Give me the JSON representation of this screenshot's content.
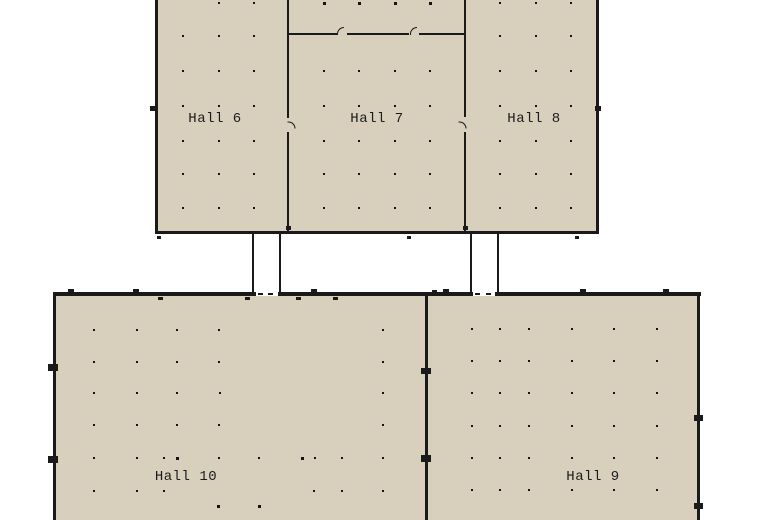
{
  "map": {
    "type": "venue-floor-plan",
    "halls": [
      {
        "id": "hall-6",
        "label": "Hall 6"
      },
      {
        "id": "hall-7",
        "label": "Hall 7"
      },
      {
        "id": "hall-8",
        "label": "Hall 8"
      },
      {
        "id": "hall-9",
        "label": "Hall 9"
      },
      {
        "id": "hall-10",
        "label": "Hall 10"
      }
    ]
  },
  "colors": {
    "background": "#ffffff",
    "hall_fill": "#d8cfbd",
    "wall": "#1a1a1a",
    "corridor": "#ffffff",
    "dot": "#141414",
    "label": "#1c1c1c"
  },
  "dots": {
    "points": [
      [
        218,
        2
      ],
      [
        253,
        2
      ],
      [
        182,
        35
      ],
      [
        218,
        35
      ],
      [
        253,
        35
      ],
      [
        182,
        70
      ],
      [
        218,
        70
      ],
      [
        253,
        70
      ],
      [
        182,
        105
      ],
      [
        218,
        105
      ],
      [
        253,
        105
      ],
      [
        182,
        140
      ],
      [
        218,
        140
      ],
      [
        253,
        140
      ],
      [
        182,
        173
      ],
      [
        218,
        173
      ],
      [
        253,
        173
      ],
      [
        182,
        207
      ],
      [
        218,
        207
      ],
      [
        253,
        207
      ],
      [
        323,
        70
      ],
      [
        358,
        70
      ],
      [
        394,
        70
      ],
      [
        429,
        70
      ],
      [
        323,
        105
      ],
      [
        358,
        105
      ],
      [
        394,
        105
      ],
      [
        429,
        105
      ],
      [
        323,
        140
      ],
      [
        358,
        140
      ],
      [
        394,
        140
      ],
      [
        429,
        140
      ],
      [
        323,
        173
      ],
      [
        358,
        173
      ],
      [
        394,
        173
      ],
      [
        429,
        173
      ],
      [
        323,
        207
      ],
      [
        358,
        207
      ],
      [
        394,
        207
      ],
      [
        429,
        207
      ],
      [
        499,
        2
      ],
      [
        535,
        2
      ],
      [
        570,
        2
      ],
      [
        499,
        35
      ],
      [
        535,
        35
      ],
      [
        570,
        35
      ],
      [
        499,
        70
      ],
      [
        535,
        70
      ],
      [
        570,
        70
      ],
      [
        499,
        105
      ],
      [
        535,
        105
      ],
      [
        570,
        105
      ],
      [
        499,
        140
      ],
      [
        535,
        140
      ],
      [
        570,
        140
      ],
      [
        499,
        173
      ],
      [
        535,
        173
      ],
      [
        570,
        173
      ],
      [
        499,
        207
      ],
      [
        535,
        207
      ],
      [
        570,
        207
      ],
      [
        471,
        328
      ],
      [
        499,
        328
      ],
      [
        528,
        328
      ],
      [
        571,
        328
      ],
      [
        613,
        328
      ],
      [
        656,
        328
      ],
      [
        471,
        360
      ],
      [
        499,
        360
      ],
      [
        528,
        360
      ],
      [
        571,
        360
      ],
      [
        613,
        360
      ],
      [
        656,
        360
      ],
      [
        471,
        392
      ],
      [
        499,
        392
      ],
      [
        528,
        392
      ],
      [
        571,
        392
      ],
      [
        613,
        392
      ],
      [
        656,
        392
      ],
      [
        471,
        425
      ],
      [
        499,
        425
      ],
      [
        528,
        425
      ],
      [
        571,
        425
      ],
      [
        613,
        425
      ],
      [
        656,
        425
      ],
      [
        471,
        457
      ],
      [
        499,
        457
      ],
      [
        528,
        457
      ],
      [
        571,
        457
      ],
      [
        613,
        457
      ],
      [
        656,
        457
      ],
      [
        471,
        489
      ],
      [
        499,
        489
      ],
      [
        528,
        489
      ],
      [
        571,
        489
      ],
      [
        613,
        489
      ],
      [
        656,
        489
      ],
      [
        93,
        329
      ],
      [
        136,
        329
      ],
      [
        176,
        329
      ],
      [
        218,
        329
      ],
      [
        382,
        329
      ],
      [
        93,
        361
      ],
      [
        136,
        361
      ],
      [
        176,
        361
      ],
      [
        218,
        361
      ],
      [
        382,
        361
      ],
      [
        93,
        392
      ],
      [
        136,
        392
      ],
      [
        176,
        392
      ],
      [
        219,
        392
      ],
      [
        382,
        392
      ],
      [
        93,
        424
      ],
      [
        136,
        424
      ],
      [
        176,
        424
      ],
      [
        218,
        424
      ],
      [
        382,
        424
      ],
      [
        93,
        457
      ],
      [
        136,
        457
      ],
      [
        163,
        457
      ],
      [
        218,
        457
      ],
      [
        258,
        457
      ],
      [
        314,
        457
      ],
      [
        341,
        457
      ],
      [
        382,
        457
      ],
      [
        93,
        490
      ],
      [
        136,
        490
      ],
      [
        163,
        490
      ],
      [
        313,
        490
      ],
      [
        341,
        490
      ],
      [
        382,
        490
      ]
    ],
    "bold": [
      [
        323,
        2
      ],
      [
        358,
        2
      ],
      [
        394,
        2
      ],
      [
        429,
        2
      ],
      [
        176,
        457
      ],
      [
        301,
        457
      ],
      [
        217,
        505
      ],
      [
        258,
        505
      ]
    ]
  },
  "doors": {
    "marks": [
      [
        150,
        106,
        6,
        5
      ],
      [
        595,
        106,
        6,
        5
      ],
      [
        157,
        236,
        4,
        3
      ],
      [
        407,
        236,
        4,
        3
      ],
      [
        575,
        236,
        4,
        3
      ],
      [
        286,
        226,
        5,
        4
      ],
      [
        463,
        226,
        5,
        4
      ],
      [
        68,
        289,
        6,
        4
      ],
      [
        133,
        289,
        6,
        4
      ],
      [
        311,
        289,
        6,
        4
      ],
      [
        432,
        290,
        5,
        3
      ],
      [
        443,
        289,
        6,
        4
      ],
      [
        580,
        289,
        6,
        4
      ],
      [
        663,
        289,
        6,
        4
      ],
      [
        158,
        297,
        5,
        3
      ],
      [
        245,
        297,
        5,
        3
      ],
      [
        296,
        297,
        5,
        3
      ],
      [
        333,
        297,
        5,
        3
      ],
      [
        258,
        293,
        5,
        2
      ],
      [
        268,
        293,
        5,
        2
      ],
      [
        475,
        293,
        5,
        2
      ],
      [
        486,
        293,
        5,
        2
      ],
      [
        48,
        364,
        10,
        7
      ],
      [
        48,
        456,
        10,
        7
      ],
      [
        421,
        368,
        10,
        6
      ],
      [
        421,
        455,
        10,
        7
      ],
      [
        694,
        415,
        9,
        6
      ],
      [
        694,
        503,
        9,
        6
      ]
    ],
    "hooks": [
      [
        337,
        27,
        0
      ],
      [
        410,
        27,
        0
      ],
      [
        288,
        121,
        90
      ],
      [
        459,
        121,
        90
      ]
    ]
  }
}
